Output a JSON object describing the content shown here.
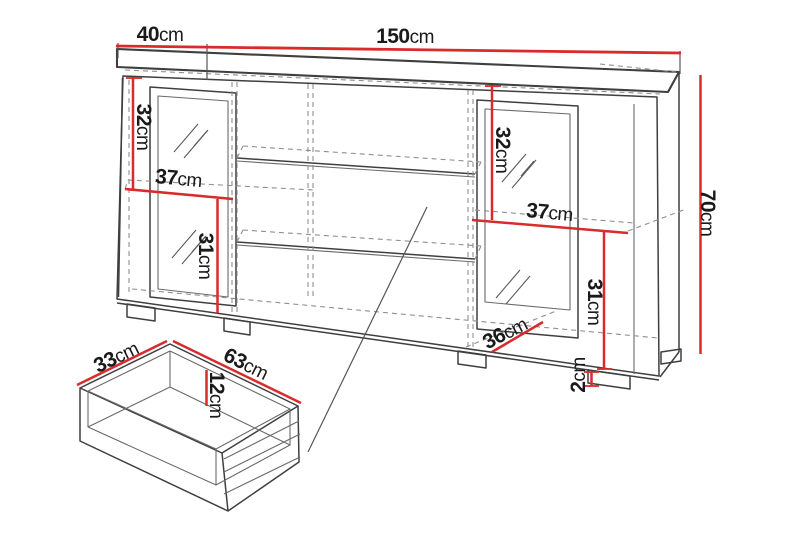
{
  "diagram": {
    "subject": "sideboard-cabinet-with-drawer-dimensions"
  },
  "dimensions": {
    "top_depth": {
      "value": "40",
      "unit": "cm"
    },
    "top_width": {
      "value": "150",
      "unit": "cm"
    },
    "height": {
      "value": "70",
      "unit": "cm"
    },
    "left_door_glass": {
      "value": "32",
      "unit": "cm"
    },
    "left_shelf": {
      "value": "37",
      "unit": "cm"
    },
    "left_lower": {
      "value": "31",
      "unit": "cm"
    },
    "right_door_glass": {
      "value": "32",
      "unit": "cm"
    },
    "right_shelf": {
      "value": "37",
      "unit": "cm"
    },
    "right_lower": {
      "value": "31",
      "unit": "cm"
    },
    "interior_depth": {
      "value": "36",
      "unit": "cm"
    },
    "foot_height": {
      "value": "2",
      "unit": "cm"
    },
    "drawer_depth": {
      "value": "33",
      "unit": "cm"
    },
    "drawer_width": {
      "value": "63",
      "unit": "cm"
    },
    "drawer_height": {
      "value": "12",
      "unit": "cm"
    }
  },
  "colors": {
    "dimension": "#d92b2b",
    "outline": "#3f3f3f",
    "hidden": "#8f8f8f",
    "text": "#1a1a1a",
    "background": "#ffffff"
  }
}
